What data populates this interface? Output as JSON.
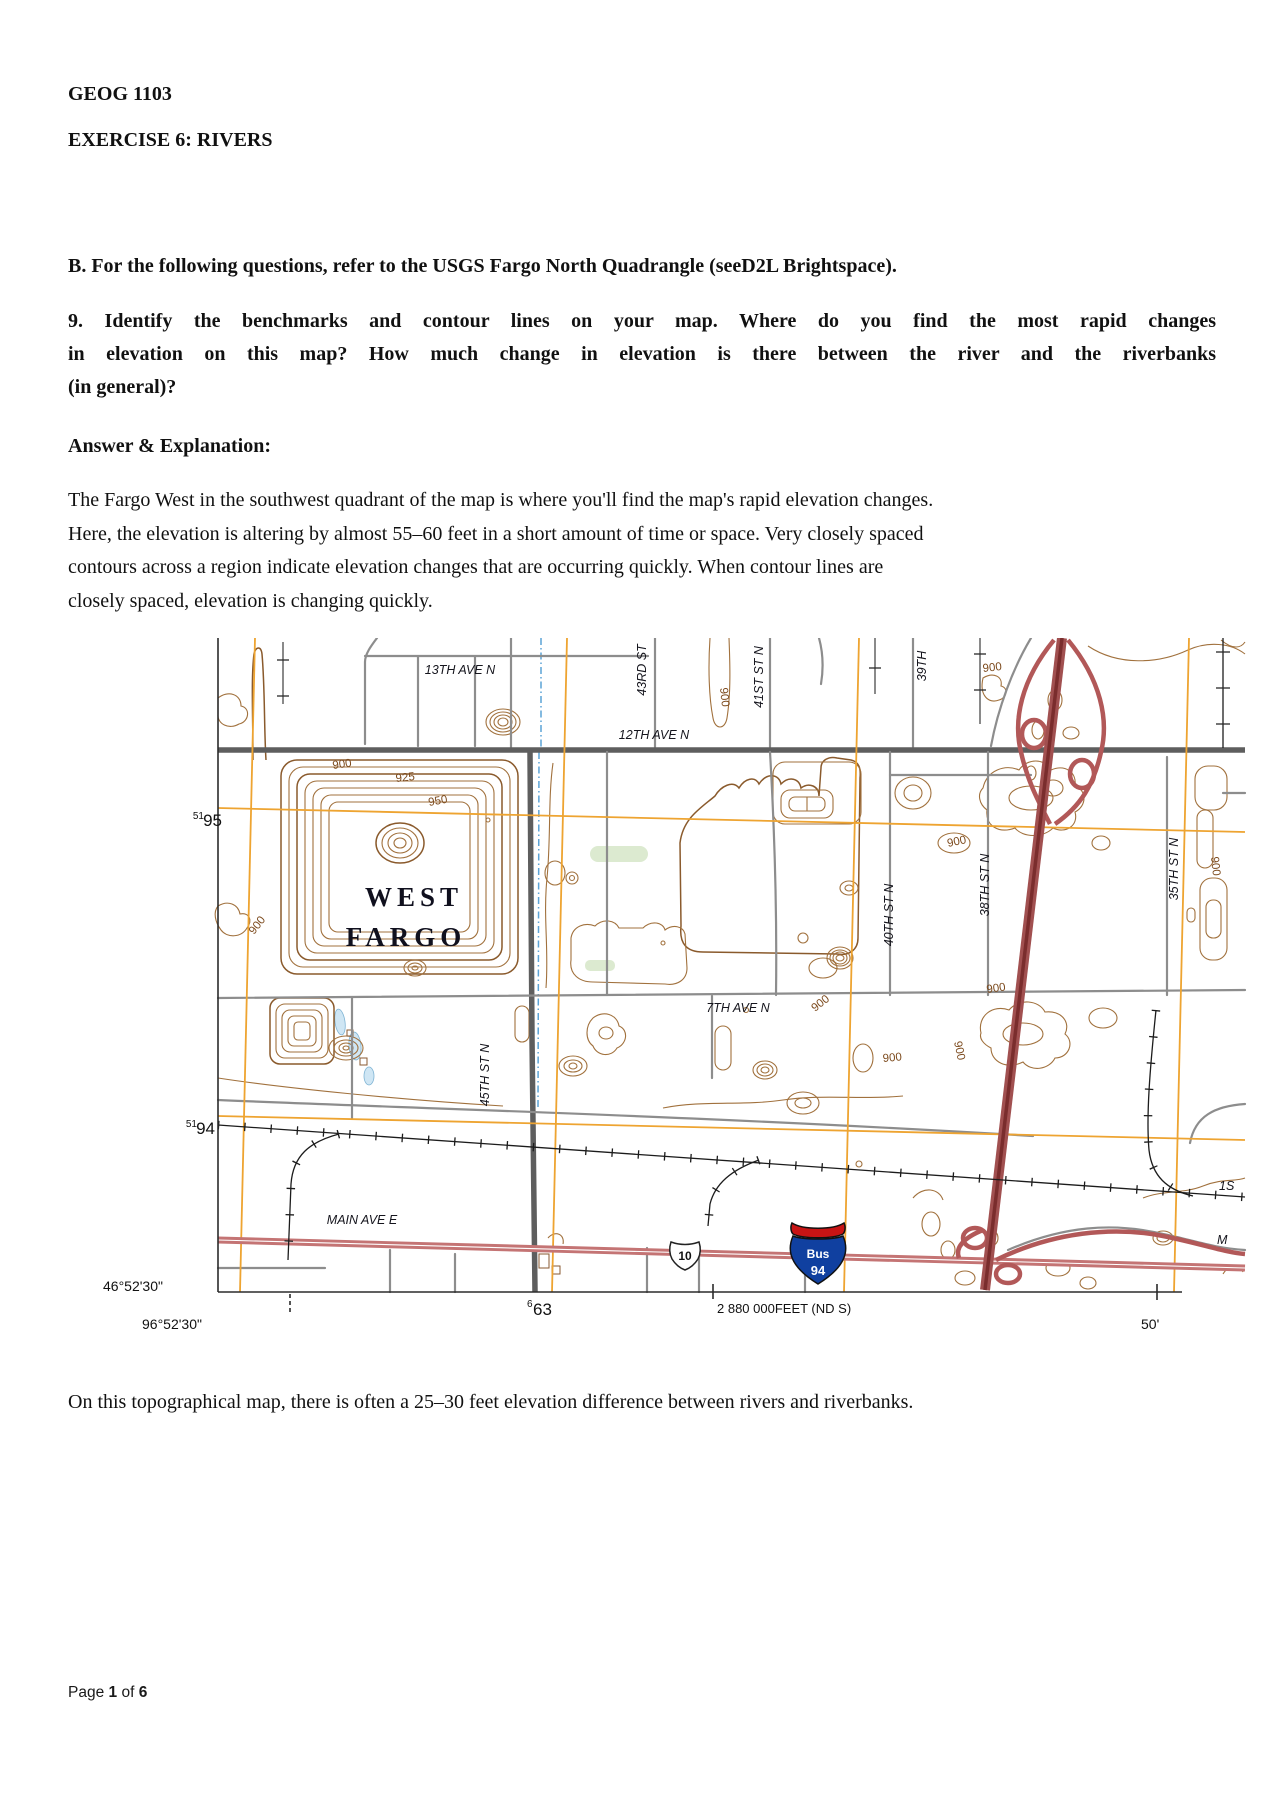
{
  "document": {
    "course": "GEOG 1103",
    "exercise_title": "EXERCISE 6: RIVERS",
    "section_b": "B. For the following questions, refer to the USGS Fargo North Quadrangle (seeD2L Brightspace).",
    "question9_lines": [
      "9. Identify the benchmarks and contour lines on your map. Where do you find the most rapid changes",
      "in elevation on this map? How much change in elevation is there between the river and the riverbanks",
      "(in general)?"
    ],
    "answer_heading": "Answer & Explanation:",
    "answer_lines": [
      "The Fargo West in the southwest quadrant of the map is where you'll find the map's rapid elevation changes.",
      "Here, the elevation is altering by almost 55–60 feet in a short amount of time or space. Very closely spaced",
      "contours across a region indicate elevation changes that are occurring quickly. When contour lines are",
      "closely spaced, elevation is changing quickly."
    ],
    "closing_paragraph": "On this topographical map, there is often a 25–30 feet elevation difference between rivers and riverbanks.",
    "footer": {
      "prefix": "Page",
      "page_number": "1",
      "of_word": "of",
      "total_pages": "6"
    }
  },
  "map": {
    "place": {
      "line1": "WEST",
      "line2": "FARGO"
    },
    "streets": {
      "ave13": "13TH AVE N",
      "ave12": "12TH AVE N",
      "ave7": "7TH AVE N",
      "main": "MAIN AVE E",
      "st43": "43RD ST",
      "st41": "41ST ST N",
      "st39": "39TH",
      "st45": "45TH ST N",
      "st40": "40TH ST N",
      "st38": "38TH ST N",
      "st35": "35TH ST N",
      "cut_right_1": "1S",
      "cut_right_2": "M"
    },
    "contour_labels": {
      "c900": "900",
      "c925": "925",
      "c950": "950"
    },
    "grid": {
      "northing1_sup": "51",
      "northing1": "95",
      "northing2_sup": "51",
      "northing2": "94",
      "easting_sup": "6",
      "easting": "63",
      "latitude": "46°52'30\"",
      "longitude": "96°52'30\"",
      "feet_label": "2 880 000FEET (ND S)",
      "corner_label": "50'"
    },
    "shields": {
      "us_route": "10",
      "bus_word": "Bus",
      "interstate": "94"
    },
    "colors": {
      "contour": "#a1713d",
      "utm_grid": "#eea431",
      "interstate": "#a15050",
      "highway": "#c47474",
      "water": "#cfe6f4",
      "woodland": "#dcead0"
    }
  }
}
